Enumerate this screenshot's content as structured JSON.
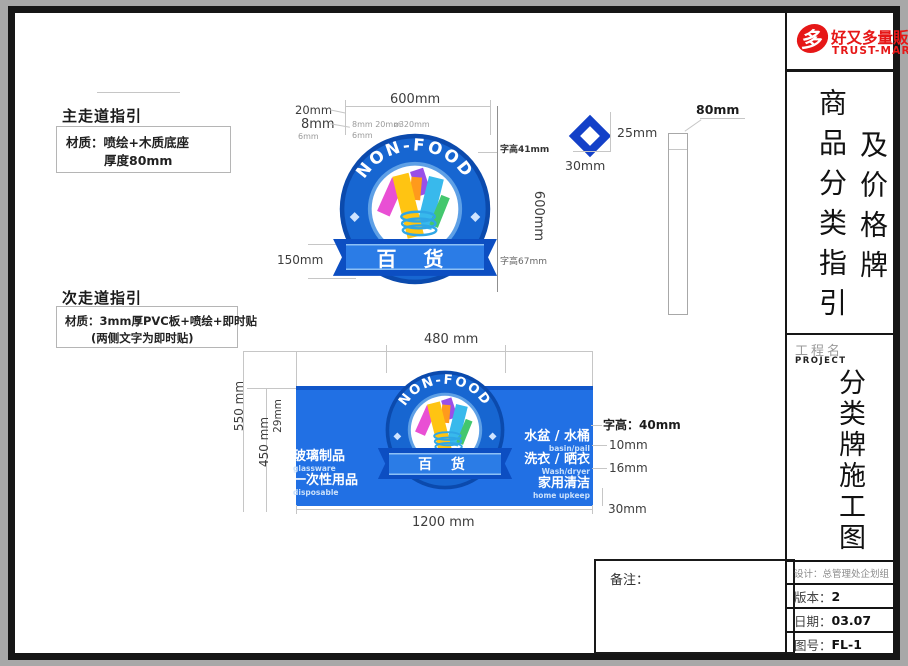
{
  "logo": {
    "icon_char": "多",
    "brand": "好又多量販",
    "sub": "TRUST-MART"
  },
  "sidebar": {
    "title_left": "商品分类指引",
    "title_right": "及价格牌",
    "project_label": "工程名",
    "project_en": "PROJECT",
    "project_title": "分类牌施工图",
    "info": [
      {
        "label": "设计：",
        "value": "总管理处企划组"
      },
      {
        "label": "版本：",
        "value": "2"
      },
      {
        "label": "日期：",
        "value": "03.07"
      },
      {
        "label": "图号：",
        "value": "FL-1"
      }
    ]
  },
  "remarks_label": "备注：",
  "primary": {
    "heading": "主走道指引",
    "material1": "材质：喷绘+木质底座",
    "material2": "厚度80mm"
  },
  "secondary": {
    "heading": "次走道指引",
    "material1": "材质：3mm厚PVC板+喷绘+即时贴",
    "material2": "(两侧文字为即时贴)"
  },
  "badge": {
    "arc": "NON-FOOD",
    "ribbon": "百 货"
  },
  "sign1": {
    "w": "600mm",
    "d20": "20mm",
    "d8": "8mm",
    "d6": "6mm",
    "inner1": "8mm 20mm",
    "inner2": "⌀320mm",
    "inner3": "6mm",
    "h": "600mm",
    "char1": "字高41mm",
    "char2": "字高67mm",
    "ribbon_h": "150mm"
  },
  "diamond": {
    "h": "25mm",
    "w": "30mm"
  },
  "sideview": {
    "t": "80mm"
  },
  "sign2": {
    "w": "480 mm",
    "bw": "1200 mm",
    "h1": "550 mm",
    "h2": "450 mm",
    "h3": "29mm",
    "char": "字高：40mm",
    "g1": "10mm",
    "g2": "16mm",
    "g3": "30mm",
    "left": [
      {
        "zh": "玻璃制品",
        "en": "glassware"
      },
      {
        "zh": "一次性用品",
        "en": "disposable"
      }
    ],
    "right": [
      {
        "zh": "水盆 / 水桶",
        "en": "basin/pail"
      },
      {
        "zh": "洗衣 / 晒衣",
        "en": "Wash/dryer"
      },
      {
        "zh": "家用清洁",
        "en": "home upkeep"
      }
    ]
  },
  "colors": {
    "badge_blue": "#1766d1",
    "ribbon_blue": "#0c4ec2",
    "panel_blue": "#2170e4",
    "logo_red": "#e61717"
  }
}
